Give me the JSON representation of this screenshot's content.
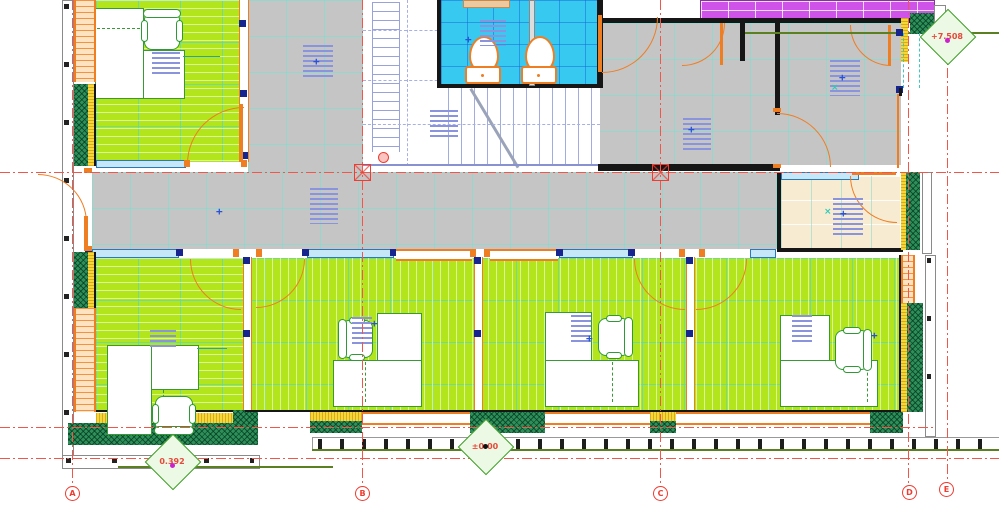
{
  "drawing": {
    "kind": "architectural-floor-plan",
    "levels": {
      "upper": "+7.508",
      "entry": "0.392",
      "ground": "±0.00"
    },
    "grid": {
      "axes": [
        {
          "label": "A"
        },
        {
          "label": "B"
        },
        {
          "label": "C"
        },
        {
          "label": "D"
        },
        {
          "label": "E"
        }
      ]
    },
    "palette": {
      "floor_green": "#b2e51c",
      "floor_gray": "#c5c5c5",
      "floor_cyan": "#38c9f1",
      "floor_beige": "#f7ecd2",
      "magenta_strip": "#cf53e8",
      "wall_green_insulation": "#2e8f5a",
      "wall_yellow_insulation": "#f2d838",
      "door_orange": "#ef7d22",
      "window_blue": "#c6e7f8",
      "grid_red": "#f0564a",
      "level_line_green": "#5a8022",
      "annotation_blue": "#8a93dd"
    }
  }
}
